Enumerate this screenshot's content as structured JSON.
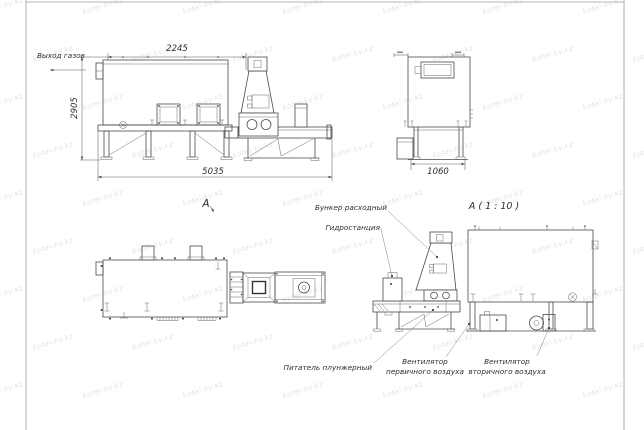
{
  "watermark": {
    "text": "kotel-kv.kz"
  },
  "side_view": {
    "gas_outlet_label": "Выход газов",
    "dim_width_top": "2245",
    "dim_height": "2905",
    "dim_length": "5035"
  },
  "end_view": {
    "dim_width": "1060"
  },
  "plan_view": {
    "view_arrow_label": "А"
  },
  "detail_view": {
    "title": "А ( 1 : 10 )",
    "labels": {
      "hopper": "Бункер расходный",
      "hydrostation": "Гидростанция",
      "feeder": "Питатель плунжерный",
      "fan_primary_line1": "Вентилятор",
      "fan_primary_line2": "первичного воздуха",
      "fan_secondary_line1": "Вентилятор",
      "fan_secondary_line2": "вторичного воздуха"
    }
  }
}
